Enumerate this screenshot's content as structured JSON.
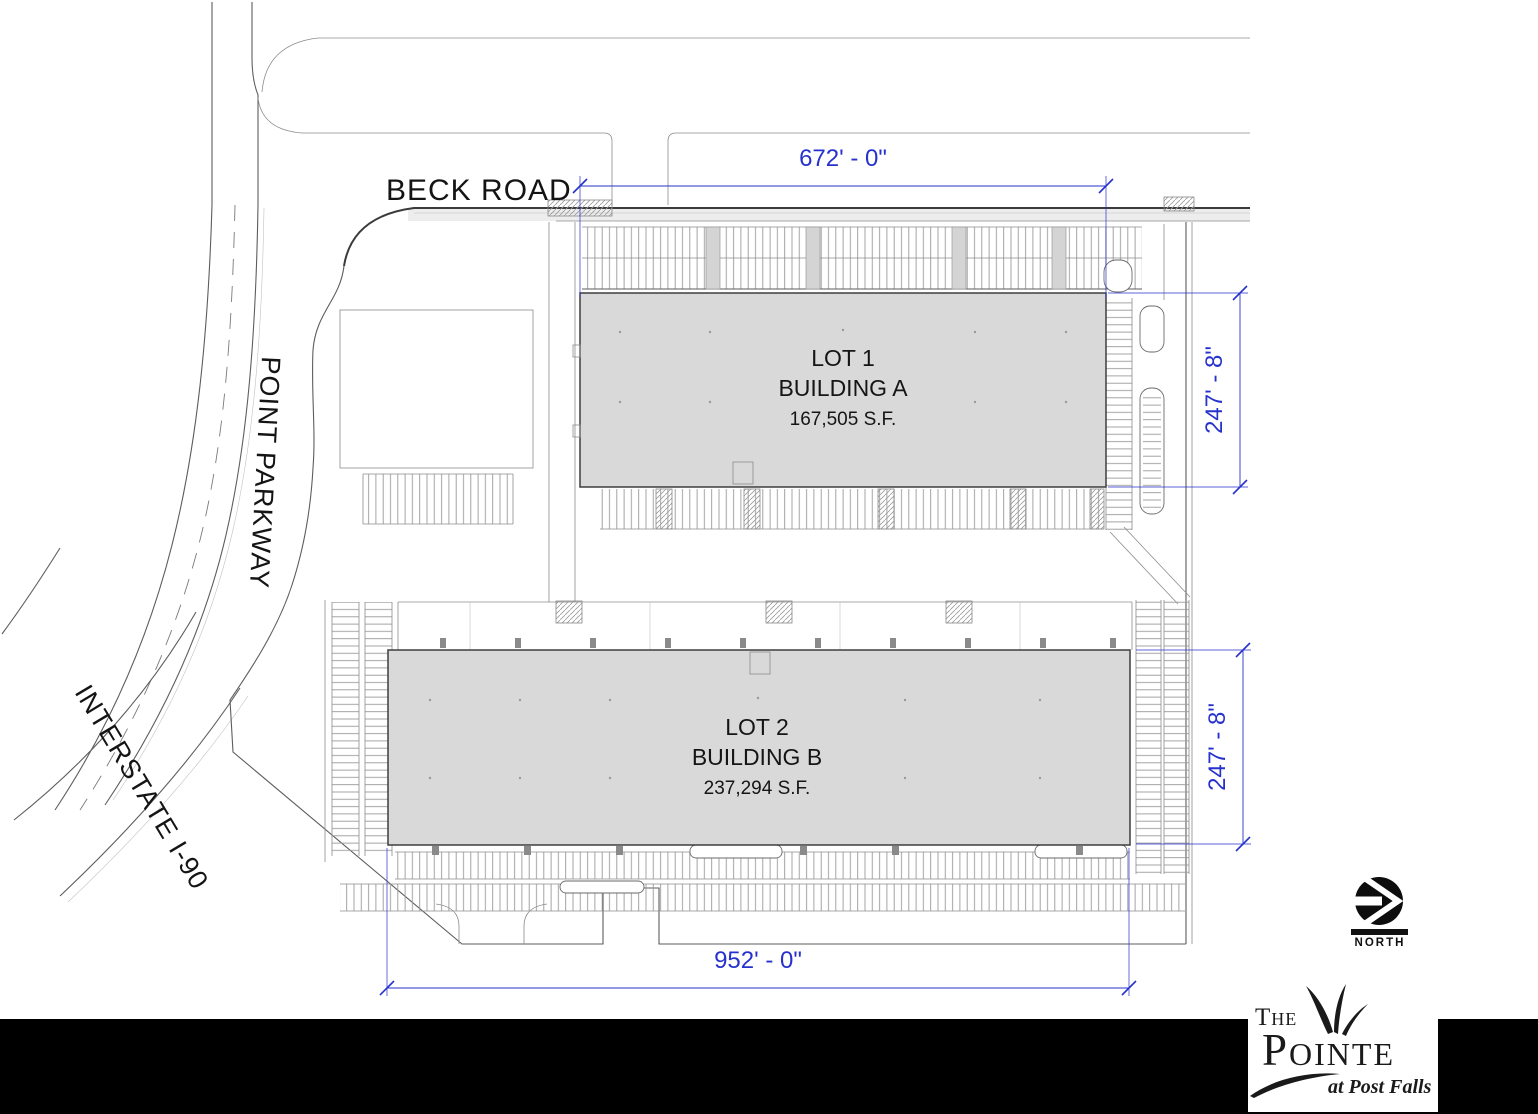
{
  "roads": {
    "beck": "BECK ROAD",
    "parkway": "POINT PARKWAY",
    "interstate": "INTERSTATE I-90"
  },
  "lots": [
    {
      "lot_label": "LOT 1",
      "building_label": "BUILDING A",
      "area_label": "167,505 S.F."
    },
    {
      "lot_label": "LOT 2",
      "building_label": "BUILDING B",
      "area_label": "237,294 S.F."
    }
  ],
  "dimensions": {
    "building_a_width": "672' - 0\"",
    "building_a_depth": "247' - 8\"",
    "building_b_depth": "247' - 8\"",
    "site_width": "952' - 0\""
  },
  "north": {
    "label": "NORTH"
  },
  "logo": {
    "line1": "The",
    "line2": "Pointe",
    "tagline": "at Post Falls"
  },
  "colors": {
    "dimension-blue": "#2732cd",
    "building-fill": "#d9d9d9",
    "linework": "#5d5d5d",
    "footer-bar": "#000000"
  }
}
